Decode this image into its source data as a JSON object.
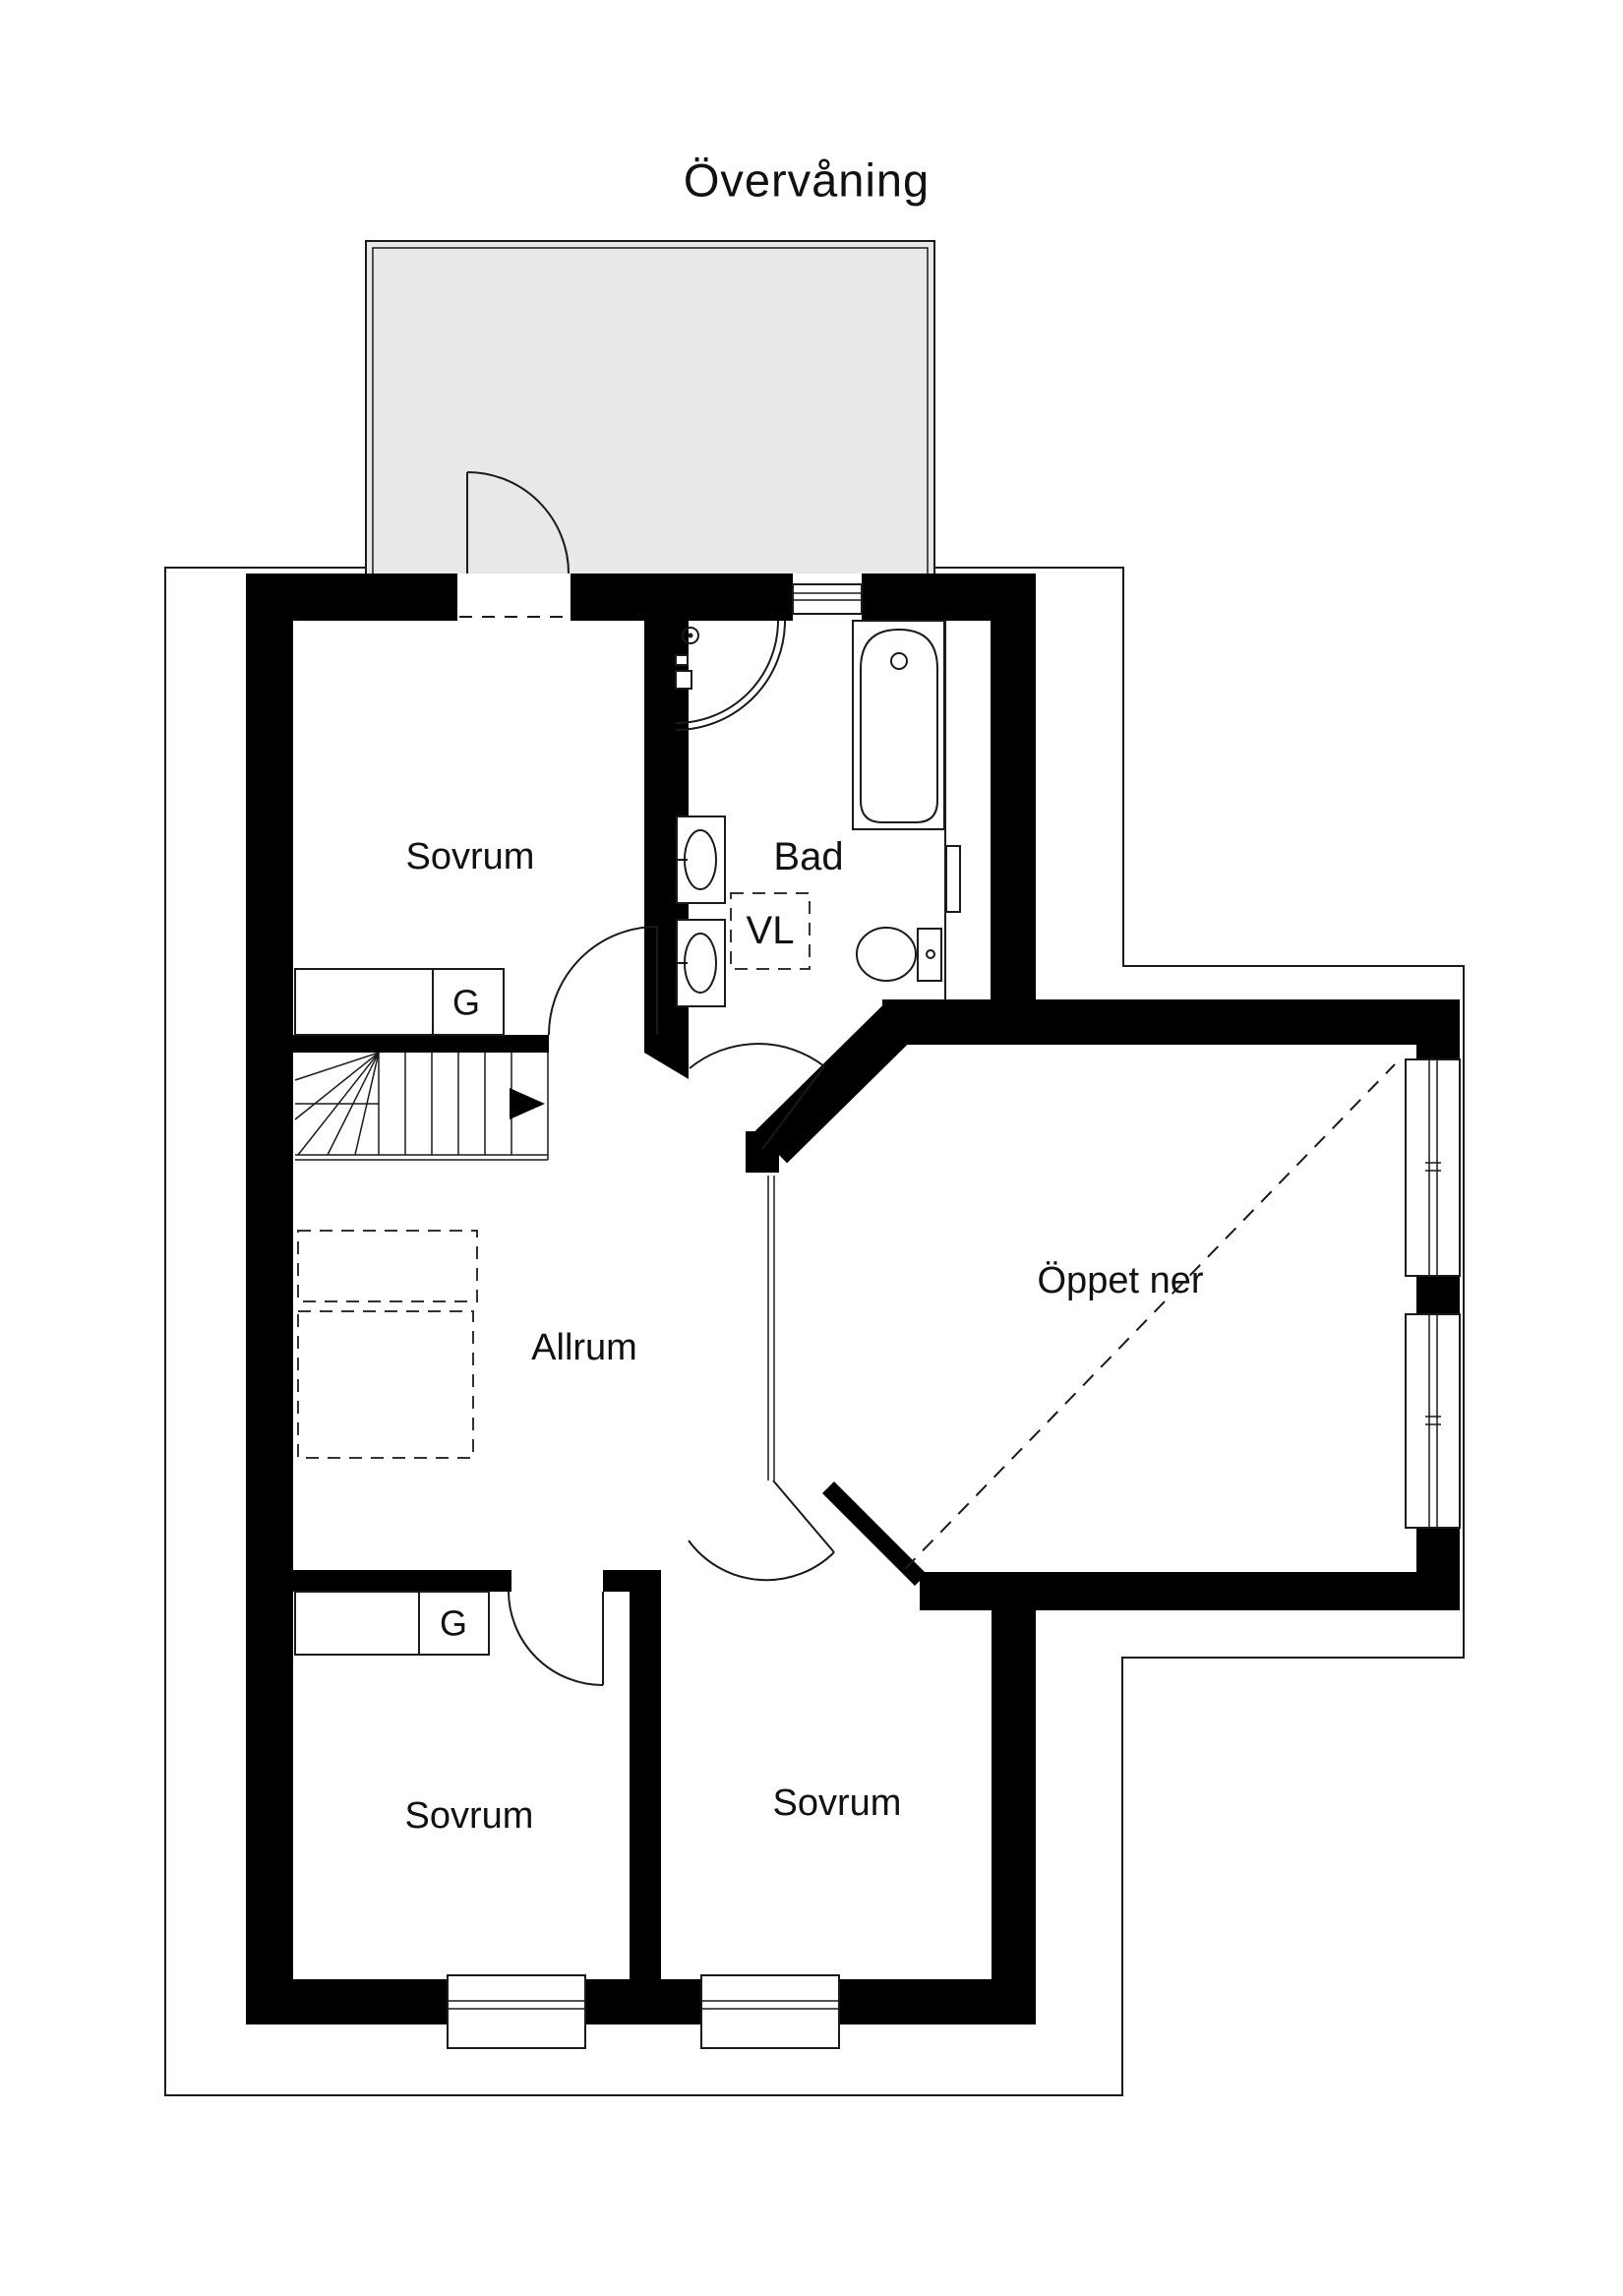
{
  "title": "Övervåning",
  "labels": {
    "bedroom_top": "Sovrum",
    "bathroom": "Bad",
    "laundry": "VL",
    "living_room": "Allrum",
    "open_to_below": "Öppet ner",
    "bedroom_bottom_left": "Sovrum",
    "bedroom_bottom_middle": "Sovrum",
    "wardrobe_top": "G",
    "wardrobe_bottom": "G"
  },
  "colors": {
    "walls": "#000000",
    "lines": "#1a1a1a",
    "balcony_fill": "#e8e8e8",
    "background": "#ffffff",
    "text": "#111111"
  },
  "icons": {
    "stairs-icon": "stair treads with up-direction arrow",
    "shower-icon": "corner shower with quarter-circle glass and shower head",
    "bathtub-icon": "bathtub with drain",
    "toilet-icon": "toilet with cistern",
    "sink-icon": "washbasin",
    "window-icon": "double-line window symbol",
    "door-swing-icon": "door leaf with quarter-circle swing arc",
    "roof-contour-icon": "thin eaves outline around plan",
    "open-below-icon": "dashed diagonal line"
  }
}
